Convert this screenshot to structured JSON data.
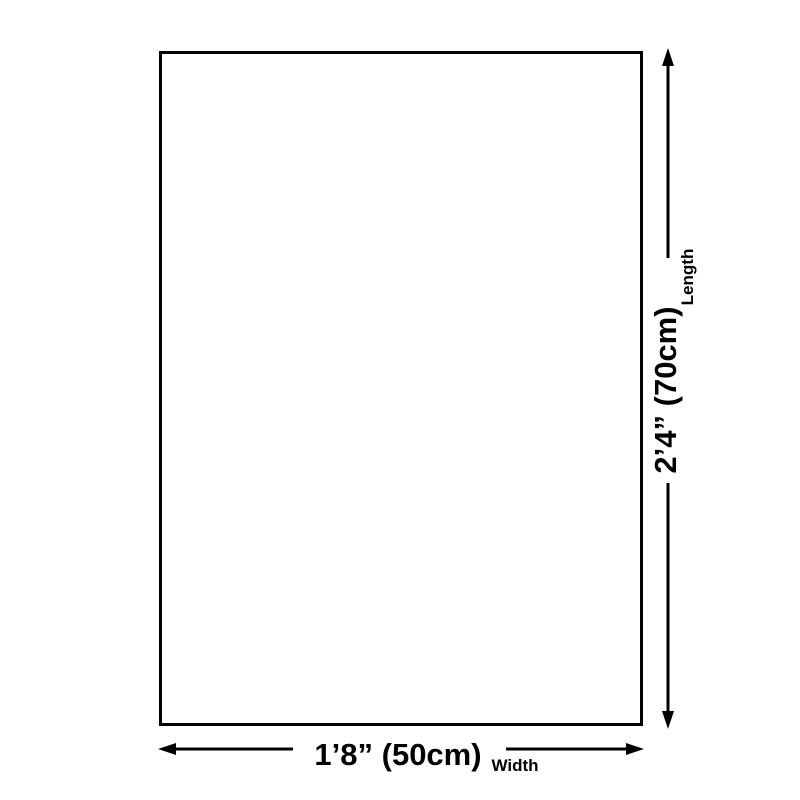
{
  "page": {
    "background_color": "#ffffff",
    "ink_color": "#000000"
  },
  "diagram": {
    "type": "product-dimension-diagram",
    "shape": "rectangle",
    "length": {
      "value": "2’4” (70cm)",
      "label": "Length"
    },
    "width": {
      "value": "1’8” (50cm)",
      "label": "Width"
    }
  }
}
